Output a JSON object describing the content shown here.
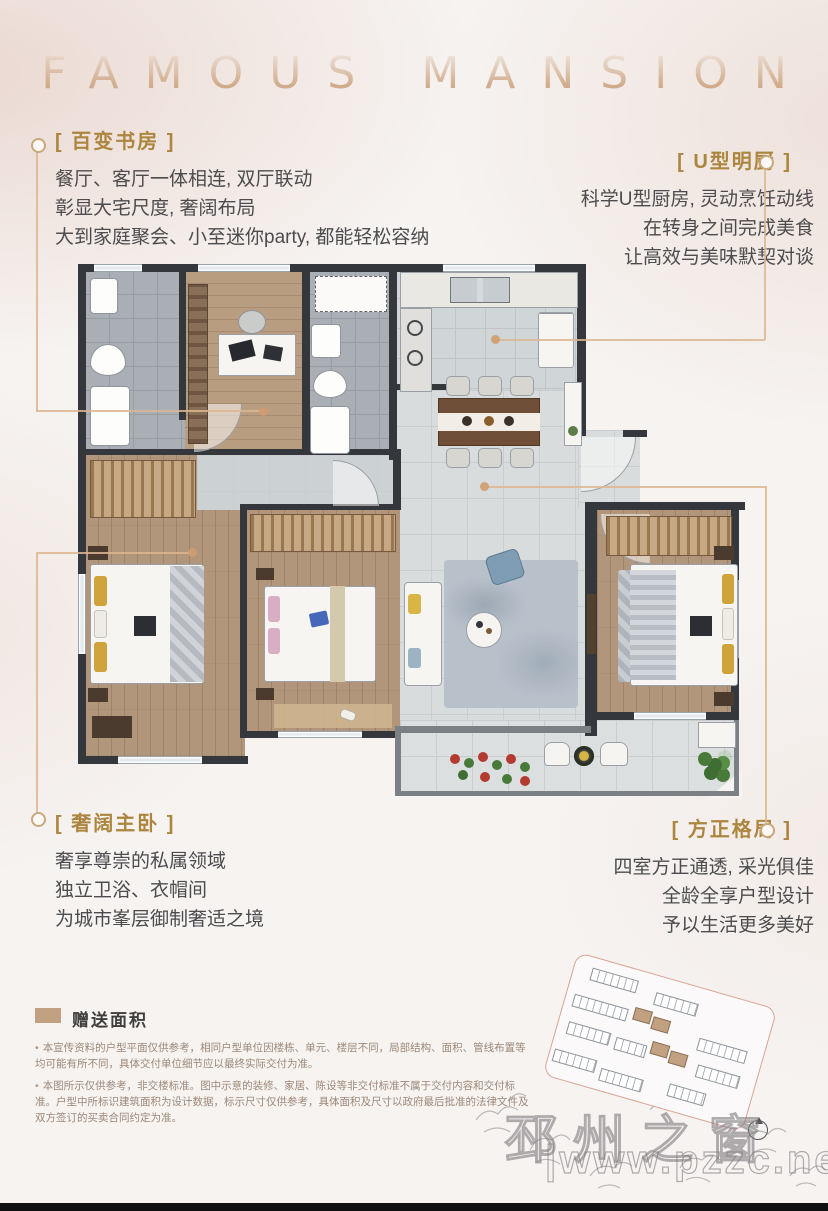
{
  "header": {
    "title": "FAMOUS MANSION"
  },
  "features": [
    {
      "id": "study",
      "title": "[ 百变书房 ]",
      "lines": [
        "餐厅、客厅一体相连, 双厅联动",
        "彰显大宅尺度, 奢阔布局",
        "大到家庭聚会、小至迷你party, 都能轻松容纳"
      ]
    },
    {
      "id": "kitchen",
      "title": "[ U型明厨 ]",
      "lines": [
        "科学U型厨房, 灵动烹饪动线",
        "在转身之间完成美食",
        "让高效与美味默契对谈"
      ]
    },
    {
      "id": "master",
      "title": "[ 奢阔主卧 ]",
      "lines": [
        "奢享尊崇的私属领域",
        "独立卫浴、衣帽间",
        "为城市峯层御制奢适之境"
      ]
    },
    {
      "id": "layout",
      "title": "[ 方正格局 ]",
      "lines": [
        "四室方正通透, 采光俱佳",
        "全龄全享户型设计",
        "予以生活更多美好"
      ]
    }
  ],
  "legend": {
    "label": "赠送面积",
    "swatch_color": "#c2a183"
  },
  "disclaimers": [
    "本宣传资料的户型平面仅供参考，相同户型单位因楼栋、单元、楼层不同，局部结构、面积、管线布置等均可能有所不同，具体交付单位细节应以最终实际交付为准。",
    "本图所示仅供参考，非交楼标准。图中示意的装修、家居、陈设等非交付标准不属于交付内容和交付标准。户型中所标识建筑面积为设计数据，标示尺寸仅供参考，具体面积及尺寸以政府最后批准的法律文件及双方签订的买卖合同约定为准。"
  ],
  "watermark": {
    "site_name": "邳州之窗",
    "url": "|www.pzzc.net"
  },
  "colors": {
    "accent_gold": "#ac853f",
    "leader_line": "#dcb691",
    "wall": "#34373b",
    "wood_floor": "#b2967b",
    "bath_tile": "#a9afb5",
    "living_tile": "#d9dcdd",
    "legend_swatch": "#c2a183",
    "thumb_border": "#d8a495"
  }
}
